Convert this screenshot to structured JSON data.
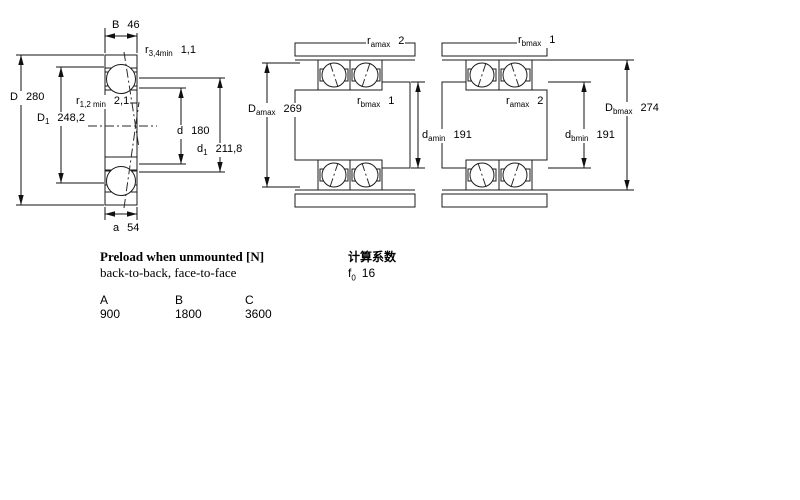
{
  "figures": {
    "single": {
      "dims": {
        "B": {
          "base": "B",
          "sub": "",
          "value": "46"
        },
        "r34": {
          "base": "r",
          "sub": "3,4min",
          "value": "1,1"
        },
        "D": {
          "base": "D",
          "sub": "",
          "value": "280"
        },
        "D1": {
          "base": "D",
          "sub": "1",
          "value": "248,2"
        },
        "r12": {
          "base": "r",
          "sub": "1,2 min",
          "value": "2,1"
        },
        "d": {
          "base": "d",
          "sub": "",
          "value": "180"
        },
        "d1": {
          "base": "d",
          "sub": "1",
          "value": "211,8"
        },
        "a": {
          "base": "a",
          "sub": "",
          "value": "54"
        }
      }
    },
    "back_to_back": {
      "dims": {
        "r_amax": {
          "base": "r",
          "sub": "amax",
          "value": "2"
        },
        "D_amax": {
          "base": "D",
          "sub": "amax",
          "value": "269"
        },
        "r_bmax": {
          "base": "r",
          "sub": "bmax",
          "value": "1"
        },
        "d_amin": {
          "base": "d",
          "sub": "amin",
          "value": "191"
        }
      }
    },
    "face_to_face": {
      "dims": {
        "r_bmax": {
          "base": "r",
          "sub": "bmax",
          "value": "1"
        },
        "r_amax": {
          "base": "r",
          "sub": "amax",
          "value": "2"
        },
        "D_bmax": {
          "base": "D",
          "sub": "bmax",
          "value": "274"
        },
        "d_bmin": {
          "base": "d",
          "sub": "bmin",
          "value": "191"
        }
      }
    }
  },
  "info": {
    "preload_title": "Preload when unmounted [N]",
    "preload_subtitle": "back-to-back, face-to-face",
    "calc_title": "计算系数",
    "f0": {
      "base": "f",
      "sub": "0",
      "value": "16"
    },
    "preload_table": {
      "headers": [
        "A",
        "B",
        "C"
      ],
      "values": [
        "900",
        "1800",
        "3600"
      ]
    }
  },
  "colors": {
    "ring_blue": "#c7d2ea",
    "ring_blue_light": "#d6def2",
    "steel_gray": "#dcdcd6",
    "steel_gray_light": "#f2f2ee",
    "line": "#1b1b1b"
  }
}
